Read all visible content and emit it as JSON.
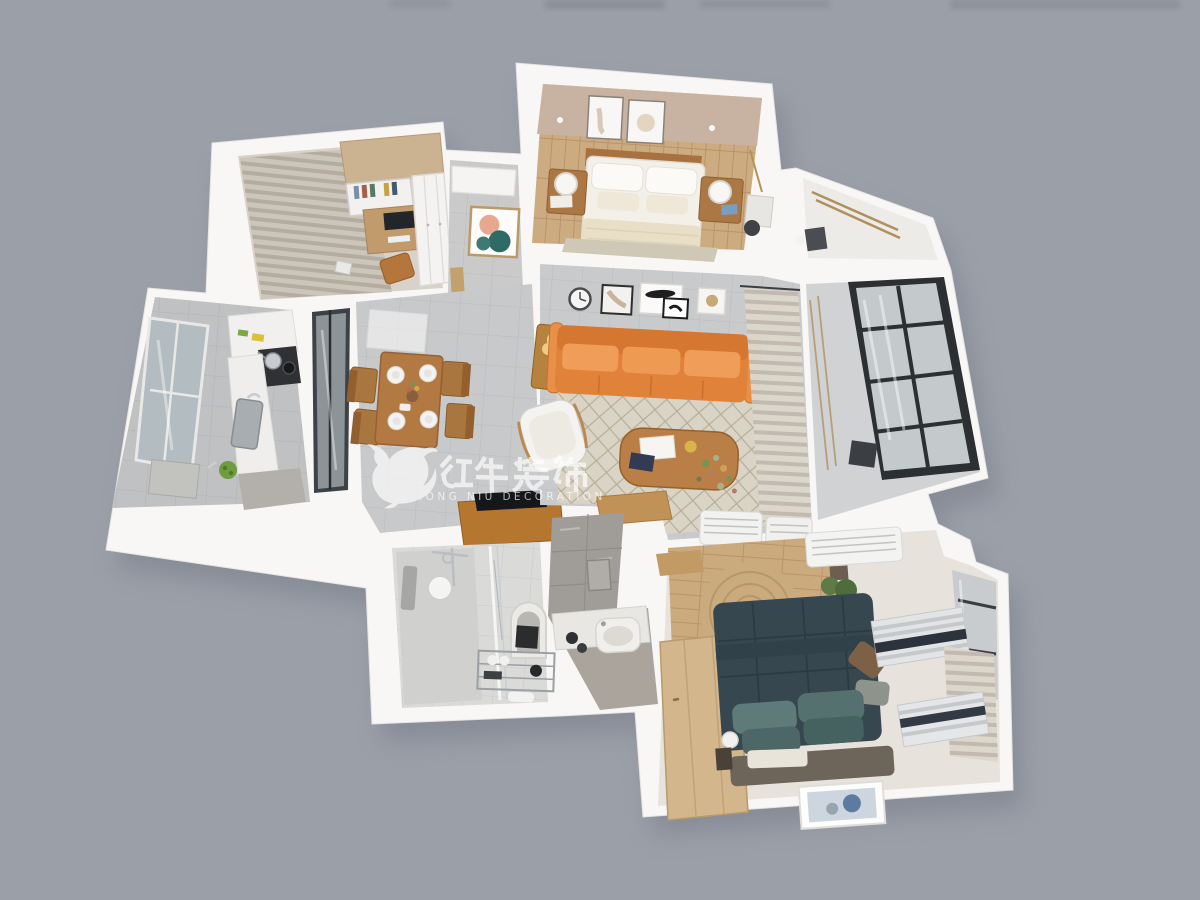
{
  "image_type": "3d-floorplan-render",
  "background_color": "#9b9fa8",
  "watermark": {
    "cn_text": "红牛装饰",
    "en_text": "HONG NIU DECORATION",
    "registered_mark": "®",
    "logo": "bull-logo",
    "color": "#ffffff"
  },
  "palette": {
    "wall": "#f7f6f4",
    "tile_floor": "#c8c9ca",
    "wood_floor": "#cdab80",
    "sofa_orange": "#e8914a",
    "bed_navy": "#37474f",
    "pillow_teal": "#5e7b79",
    "furniture_wood": "#b57e46",
    "glass_frame_black": "#2c3033",
    "rug_beige": "#dad4c6",
    "accent_wall_tan": "#c8b2a2"
  },
  "rooms": [
    {
      "name": "study",
      "furniture": [
        "curtains",
        "desk-with-monitor",
        "bookshelf",
        "wardrobe",
        "chair",
        "top-cabinet"
      ]
    },
    {
      "name": "master-bedroom",
      "furniture": [
        "double-bed",
        "headboard",
        "nightstand-left",
        "nightstand-right",
        "table-lamps",
        "wall-frames",
        "rug",
        "accent-wall"
      ]
    },
    {
      "name": "utility-balcony",
      "furniture": [
        "drying-rack"
      ]
    },
    {
      "name": "kitchen",
      "furniture": [
        "window",
        "sink",
        "stove-with-pots",
        "counters",
        "vegetable-plate"
      ]
    },
    {
      "name": "sliding-glass-door",
      "furniture": []
    },
    {
      "name": "dining-room",
      "furniture": [
        "dining-table",
        "four-plates",
        "four-chairs",
        "ceiling-glass-panel"
      ]
    },
    {
      "name": "hallway",
      "furniture": [
        "console-table",
        "wall-art",
        "tv-cabinet",
        "entry-threshold",
        "wood-door"
      ]
    },
    {
      "name": "living-room",
      "furniture": [
        "orange-sofa",
        "armchair",
        "coffee-table",
        "side-table-with-lamp",
        "diamond-rug",
        "wall-clock",
        "gallery-frames",
        "curtains",
        "air-conditioners"
      ]
    },
    {
      "name": "balcony",
      "furniture": [
        "black-framed-glazing",
        "railing",
        "chair"
      ]
    },
    {
      "name": "bathroom",
      "furniture": [
        "shower",
        "glass-partition",
        "towel",
        "arch-mirror",
        "storage-rack",
        "ceiling-lamp"
      ]
    },
    {
      "name": "vanity-corridor",
      "furniture": [
        "washbasin",
        "counter",
        "tiled-wall"
      ]
    },
    {
      "name": "second-bedroom",
      "furniture": [
        "navy-bed",
        "teal-pillows",
        "wardrobe",
        "round-jute-rug",
        "window-blinds",
        "air-conditioner",
        "hanging-plant",
        "floor-frame",
        "curtain",
        "ball-lamp",
        "bench"
      ]
    }
  ]
}
